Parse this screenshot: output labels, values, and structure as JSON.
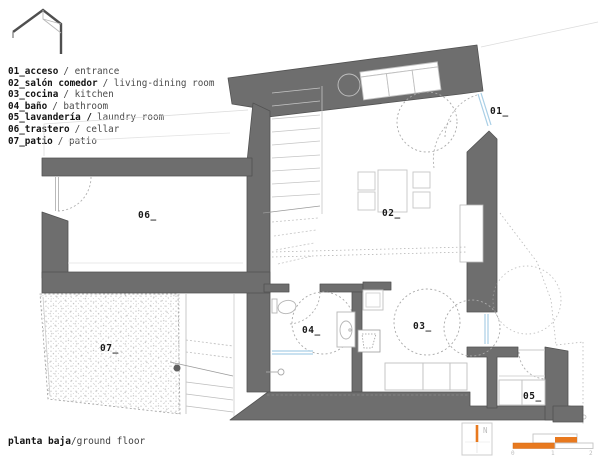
{
  "legend": {
    "items": [
      {
        "b": "01_acceso",
        "l": "/ entrance"
      },
      {
        "b": "02_salón comedor",
        "l": "/ living-dining room"
      },
      {
        "b": "03_cocina",
        "l": "/ kitchen"
      },
      {
        "b": "04_baño",
        "l": "/ bathroom"
      },
      {
        "b": "05_lavandería /",
        "l": "laundry room"
      },
      {
        "b": "06_trastero",
        "l": "/ cellar"
      },
      {
        "b": "07_patio",
        "l": "/ patio"
      }
    ]
  },
  "plan": {
    "room_labels": {
      "r01": "01_",
      "r02": "02_",
      "r03": "03_",
      "r04": "04_",
      "r05": "05_",
      "r06": "06_",
      "r07": "07_"
    }
  },
  "title": {
    "bold": "planta baja",
    "regular": "/ground floor"
  },
  "north": {
    "label": "N"
  },
  "scalebar": {
    "ticks": [
      "0",
      "1",
      "2"
    ]
  },
  "colors": {
    "wall": "#6e6e6e",
    "accent_orange": "#e8791e",
    "window_blue": "#a9cfe6"
  }
}
